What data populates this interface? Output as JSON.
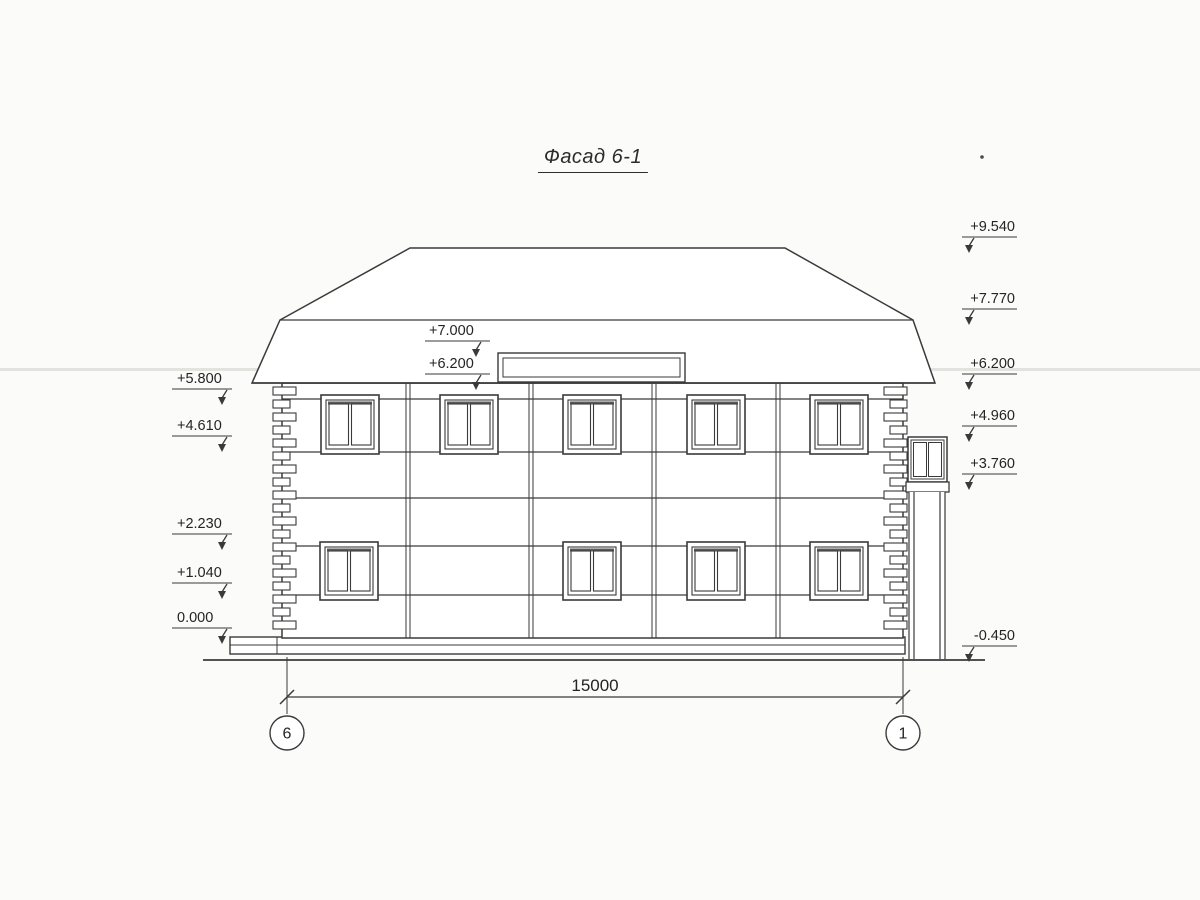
{
  "title": "Фасад 6-1",
  "colors": {
    "ink": "#3a3a3a",
    "paper": "#fbfbfa",
    "shadow": "#5a5a5a",
    "artifact": "#c9c9c4"
  },
  "elevation_marks": {
    "left": [
      {
        "label": "+5.800",
        "y": 389
      },
      {
        "label": "+4.610",
        "y": 436
      },
      {
        "label": "+2.230",
        "y": 534
      },
      {
        "label": "+1.040",
        "y": 583
      },
      {
        "label": "0.000",
        "y": 628
      }
    ],
    "middle": [
      {
        "label": "+7.000",
        "y": 341
      },
      {
        "label": "+6.200",
        "y": 374
      }
    ],
    "right": [
      {
        "label": "+9.540",
        "y": 237
      },
      {
        "label": "+7.770",
        "y": 309
      },
      {
        "label": "+6.200",
        "y": 374
      },
      {
        "label": "+4.960",
        "y": 426
      },
      {
        "label": "+3.760",
        "y": 474
      },
      {
        "label": "-0.450",
        "y": 646
      }
    ]
  },
  "dimension": {
    "label": "15000",
    "x1": 287,
    "x2": 903,
    "y": 697,
    "label_x": 595,
    "label_y": 691
  },
  "axis_bubbles": [
    {
      "label": "6",
      "x": 287,
      "y": 733,
      "r": 17
    },
    {
      "label": "1",
      "x": 903,
      "y": 733,
      "r": 17
    }
  ],
  "geometry": {
    "ground": {
      "x1": 203,
      "x2": 985,
      "y": 660
    },
    "plinth": {
      "x": 230,
      "y": 637,
      "w": 675,
      "h": 17,
      "mid_line_y": 645,
      "step_x": 277
    },
    "wall": {
      "x": 282,
      "y": 383,
      "w": 621,
      "h": 255
    },
    "band_lines_y": [
      399,
      452,
      498,
      546,
      595
    ],
    "panel_joints_x": [
      406,
      529,
      652,
      776
    ],
    "upper_windows": {
      "xs": [
        321,
        440,
        563,
        687,
        810
      ],
      "y": 395,
      "w": 58,
      "h": 59
    },
    "lower_windows": {
      "xs": [
        320,
        563,
        687,
        810
      ],
      "y": 542,
      "w": 58,
      "h": 58
    },
    "roof": {
      "eaves_y": 383,
      "eaves_x1": 252,
      "eaves_x2": 935,
      "break_y": 320,
      "break_x1": 280,
      "break_x2": 913,
      "ridge_y": 248,
      "ridge_x1": 410,
      "ridge_x2": 785
    },
    "sign_board": {
      "x": 498,
      "y": 353,
      "w": 187,
      "h": 29
    },
    "chimney": {
      "box": {
        "x": 908,
        "y": 437,
        "w": 39,
        "h": 45
      },
      "cap": {
        "x": 906,
        "y": 482,
        "w": 43,
        "h": 10
      },
      "shaft": {
        "x1": 909,
        "x2": 945,
        "inner": 5,
        "y1": 492,
        "y2": 659
      }
    },
    "quoins": {
      "left_edge_x": 282,
      "right_edge_x": 903,
      "top_y": 387,
      "count": 19,
      "step": 13,
      "block_h": 8,
      "long_w": 23,
      "short_w": 17
    }
  }
}
